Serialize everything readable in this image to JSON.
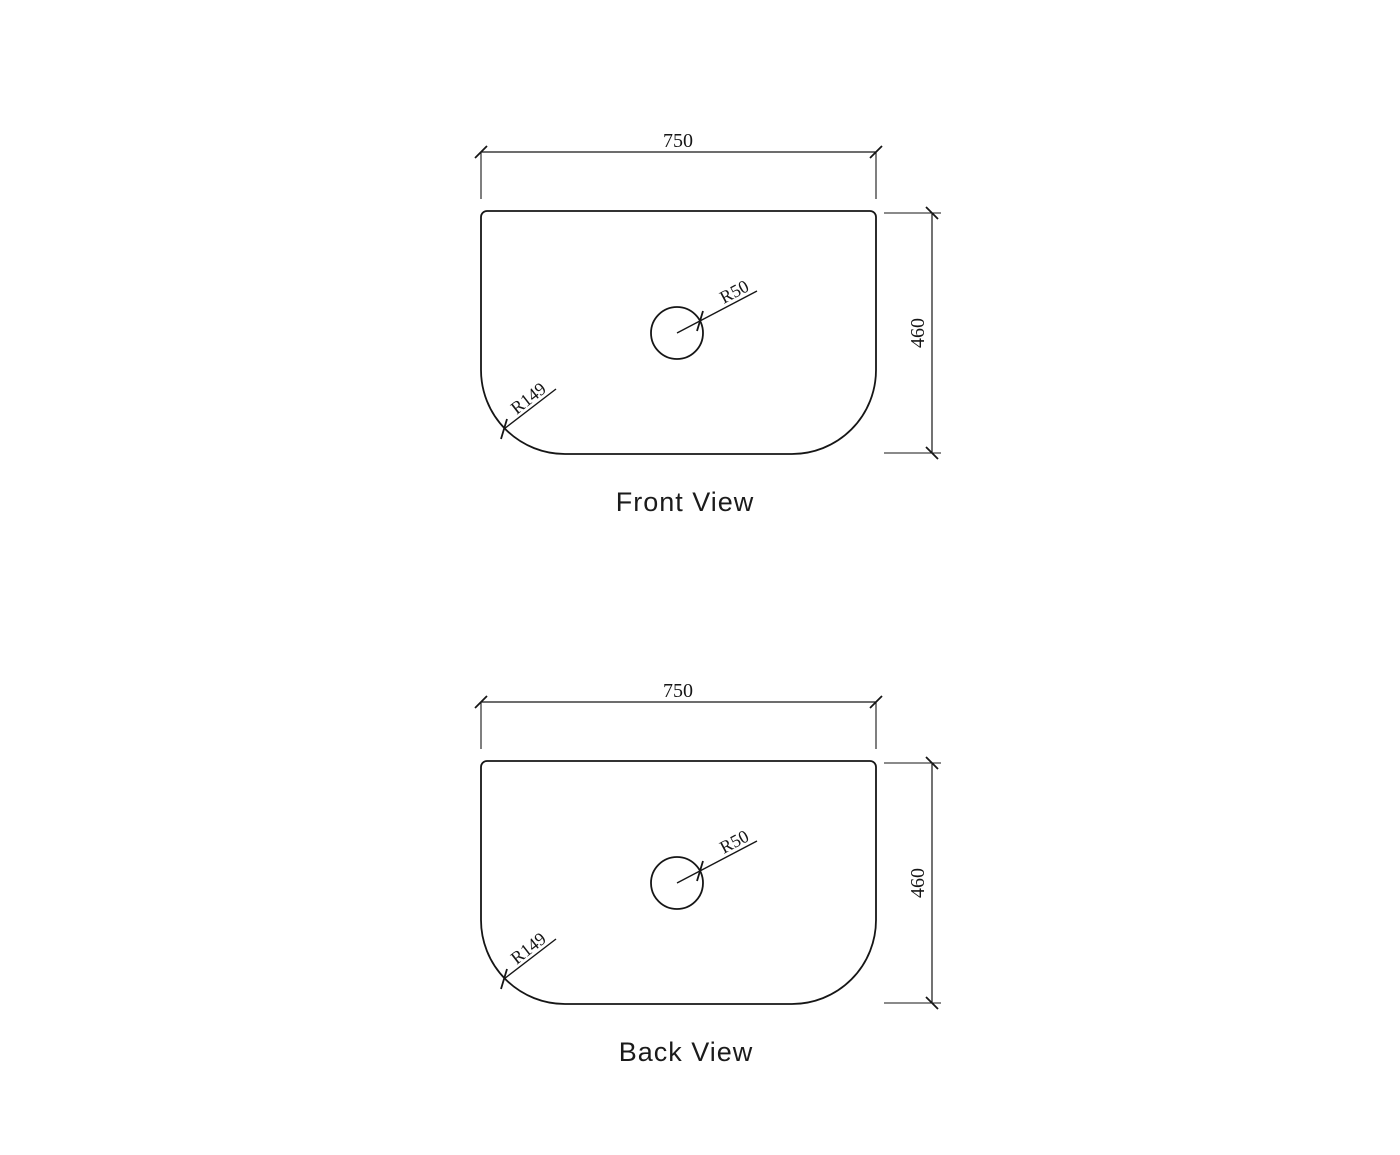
{
  "drawing": {
    "background": "#ffffff",
    "line_color": "#161616",
    "part_width_mm": 750,
    "part_height_mm": 460,
    "hole_radius_mm": 50,
    "corner_radius_mm": 149,
    "views": [
      {
        "title": "Front View",
        "width_dim": "750",
        "height_dim": "460",
        "hole_radius_label": "R50",
        "corner_radius_label": "R149"
      },
      {
        "title": "Back View",
        "width_dim": "750",
        "height_dim": "460",
        "hole_radius_label": "R50",
        "corner_radius_label": "R149"
      }
    ]
  }
}
